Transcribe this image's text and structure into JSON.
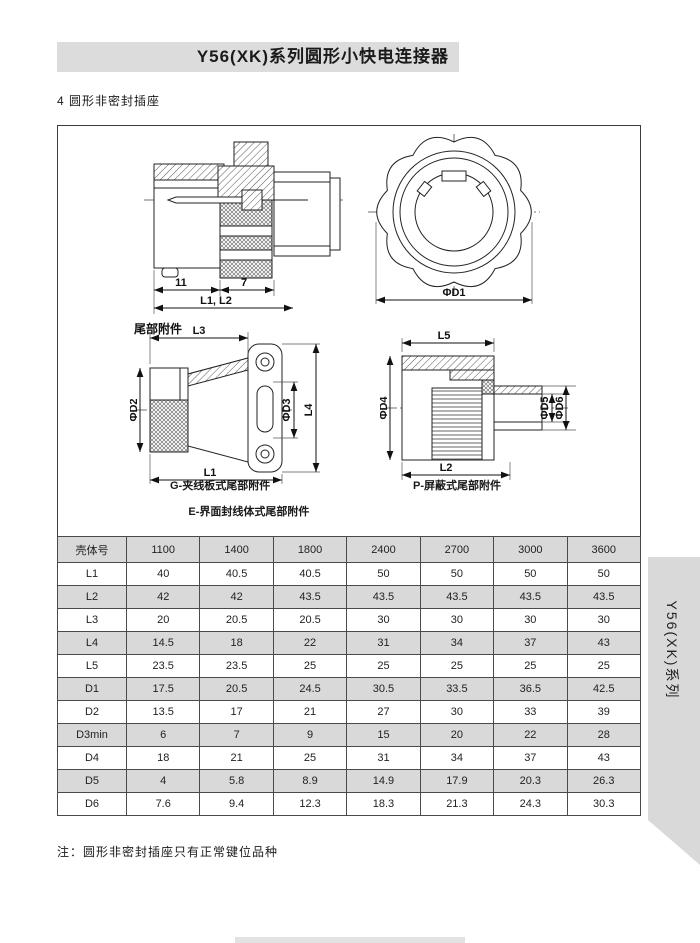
{
  "page": {
    "title": "Y56(XK)系列圆形小快电连接器",
    "section_heading": "4  圆形非密封插座",
    "note": "注：圆形非密封插座只有正常键位品种",
    "side_tab_label": "Y56(XK)系列"
  },
  "figures": {
    "plug_section": {
      "dim_11": "11",
      "dim_7": "7",
      "dim_l1l2": "L1, L2"
    },
    "front_view": {
      "dim_d1": "ΦD1"
    },
    "tail_g": {
      "label": "尾部附件",
      "dim_l3": "L3",
      "dim_d2": "ΦD2",
      "dim_d3": "ΦD3",
      "dim_l4": "L4",
      "dim_l1": "L1",
      "caption_line1": "G-夹线板式尾部附件",
      "caption_line2": "E-界面封线体式尾部附件"
    },
    "tail_p": {
      "dim_l5": "L5",
      "dim_d4": "ΦD4",
      "dim_d5": "ΦD5",
      "dim_d6": "ΦD6",
      "dim_l2": "L2",
      "caption": "P-屏蔽式尾部附件"
    }
  },
  "table": {
    "header": [
      "壳体号",
      "1100",
      "1400",
      "1800",
      "2400",
      "2700",
      "3000",
      "3600"
    ],
    "rows": [
      {
        "label": "L1",
        "values": [
          "40",
          "40.5",
          "40.5",
          "50",
          "50",
          "50",
          "50"
        ]
      },
      {
        "label": "L2",
        "values": [
          "42",
          "42",
          "43.5",
          "43.5",
          "43.5",
          "43.5",
          "43.5"
        ]
      },
      {
        "label": "L3",
        "values": [
          "20",
          "20.5",
          "20.5",
          "30",
          "30",
          "30",
          "30"
        ]
      },
      {
        "label": "L4",
        "values": [
          "14.5",
          "18",
          "22",
          "31",
          "34",
          "37",
          "43"
        ]
      },
      {
        "label": "L5",
        "values": [
          "23.5",
          "23.5",
          "25",
          "25",
          "25",
          "25",
          "25"
        ]
      },
      {
        "label": "D1",
        "values": [
          "17.5",
          "20.5",
          "24.5",
          "30.5",
          "33.5",
          "36.5",
          "42.5"
        ]
      },
      {
        "label": "D2",
        "values": [
          "13.5",
          "17",
          "21",
          "27",
          "30",
          "33",
          "39"
        ]
      },
      {
        "label": "D3min",
        "values": [
          "6",
          "7",
          "9",
          "15",
          "20",
          "22",
          "28"
        ]
      },
      {
        "label": "D4",
        "values": [
          "18",
          "21",
          "25",
          "31",
          "34",
          "37",
          "43"
        ]
      },
      {
        "label": "D5",
        "values": [
          "4",
          "5.8",
          "8.9",
          "14.9",
          "17.9",
          "20.3",
          "26.3"
        ]
      },
      {
        "label": "D6",
        "values": [
          "7.6",
          "9.4",
          "12.3",
          "18.3",
          "21.3",
          "24.3",
          "30.3"
        ]
      }
    ]
  },
  "colors": {
    "banner_bg": "#dcdcdc",
    "table_shade_bg": "#d9d9d9",
    "side_tab_bg": "#d9d9d9",
    "footer_bar_bg": "#e2e2e2",
    "line": "#222222",
    "text": "#1a1a1a"
  }
}
